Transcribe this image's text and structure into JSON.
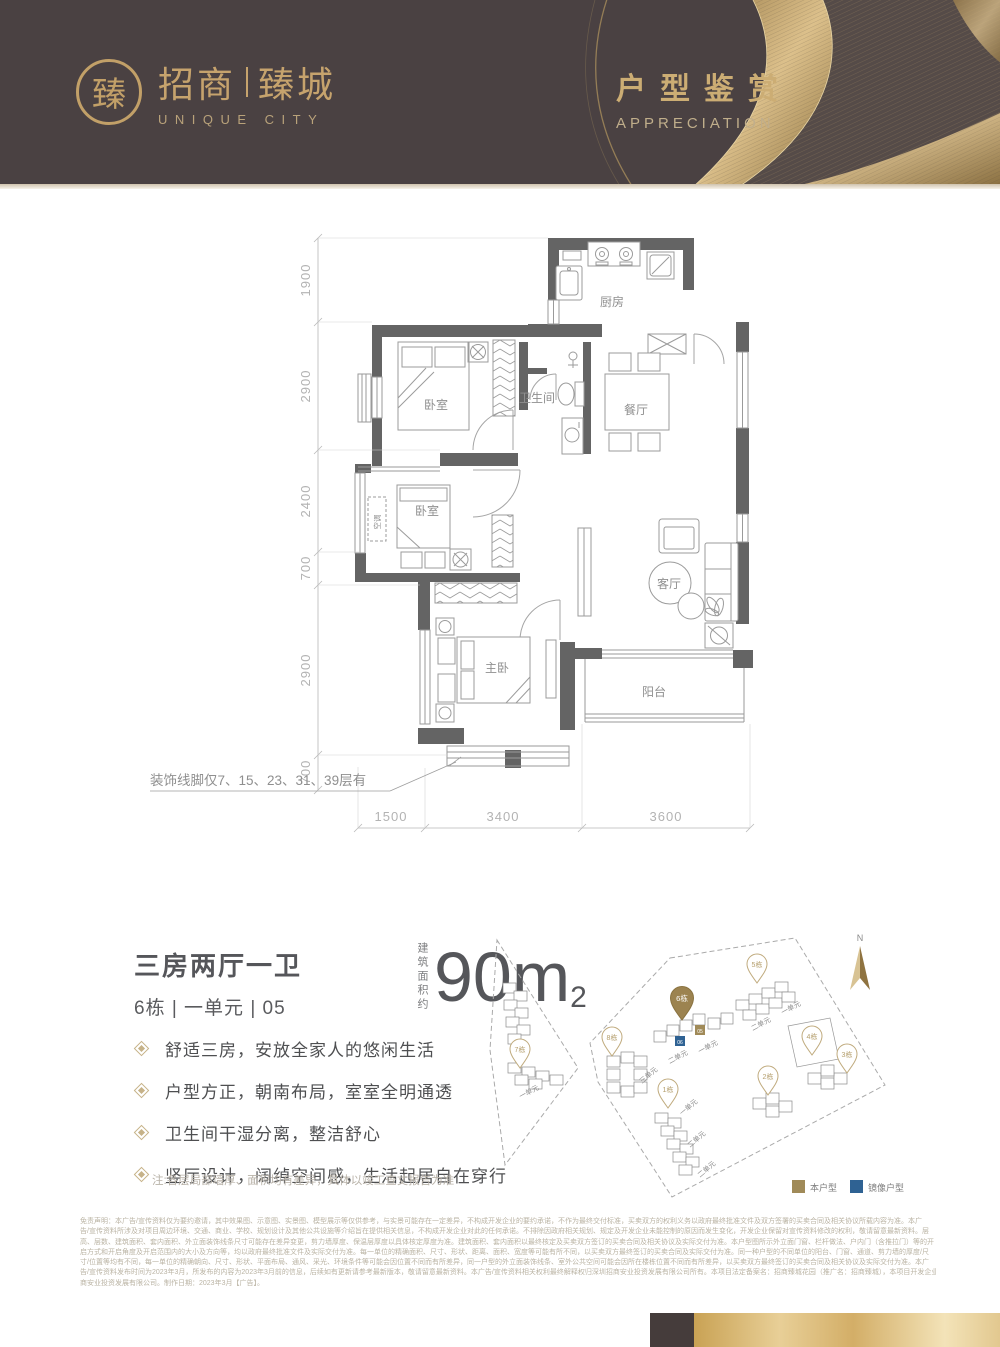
{
  "header": {
    "bg_color": "#4a4142",
    "gold_color": "#c6a36d",
    "logo_seal_char": "臻",
    "logo_cn_left": "招商",
    "logo_cn_right": "臻城",
    "logo_en": "UNIQUE CITY",
    "title_cn": "户型鉴赏",
    "title_en": "APPRECIATION"
  },
  "floorplan": {
    "rooms": {
      "kitchen": "厨房",
      "bath": "卫生间",
      "dining": "餐厅",
      "bedroom1": "卧室",
      "bedroom2": "卧室",
      "ac": "空调",
      "living": "客厅",
      "master": "主卧",
      "balcony": "阳台"
    },
    "dims_left": [
      "1900",
      "2900",
      "2400",
      "700",
      "2900",
      "700"
    ],
    "dims_bottom": [
      "1500",
      "3400",
      "3600"
    ],
    "molding_note": "装饰线脚仅7、15、23、31、39层有"
  },
  "unit_info": {
    "layout_title": "三房两厅一卫",
    "unit_line": "6栋 | 一单元 | 05",
    "area_label": "建筑面积约",
    "area_number": "90m",
    "area_sup": "2",
    "features": [
      "舒适三房，安放全家人的悠闲生活",
      "户型方正，朝南布局，室室全明通透",
      "卫生间干湿分离，整洁舒心",
      "竖厅设计，阔绰空间感，生活起居自在穿行"
    ],
    "note": "注:各层局部墙厚、面积均有差异，具体以竣工查丈报告为准"
  },
  "siteplan": {
    "north": "N",
    "buildings": {
      "b1": "1栋",
      "b2": "2栋",
      "b3": "3栋",
      "b4": "4栋",
      "b5": "5栋",
      "b6": "6栋",
      "b7": "7栋",
      "b8": "8栋"
    },
    "units": {
      "u7": "一单元",
      "u8": "三单元",
      "u6a": "二单元",
      "u6b": "一单元",
      "u5a": "二单元",
      "u5b": "一单元",
      "u1a": "一单元",
      "u1b": "二单元",
      "u1c": "二单元"
    },
    "this_unit_number": "05",
    "mirror_unit_number": "06",
    "legend_this": "本户型",
    "legend_mirror": "镜像户型",
    "colors": {
      "this": "#a08a58",
      "mirror": "#2f6293"
    }
  },
  "disclaimer": {
    "lines": [
      "免责声明：本广告/宣传资料仅为要约邀请，其中效果图、示意图、实景图、模型展示等仅供参考，与实景可能存在一定差异，不构成开发企业的要约承诺，不作为最终交付标准，买卖双方的权利义务以政府最终批准文件及双方签署的买卖合同及相关协议所载内容为准。本广",
      "告/宣传资料所涉及对项目周边环境、交通、商业、学校、规划设计及其他公共设施等介绍旨在提供相关信息，不构成开发企业对此的任何承诺。不排除因政府相关规划、规定及开发企业未能控制的原因而发生变化，开发企业保留对宣传资料修改的权利，敬请留意最新资料。层",
      "高、层数、建筑面积、套内面积、外立面装饰线条尺寸可能存在差异变更，剪力墙厚度、保温层厚度以具体核定厚度为准。建筑面积、套内面积以最终核定及买卖双方签订的买卖合同及相关协议及实际交付为准。本户型图所示外立面门窗、栏杆做法、户内门（含推拉门）等的开",
      "启方式和开启角度及开启范围内的大小及方向等，均以政府最终批准文件及实际交付为准。每一单位的精确面积、尺寸、形状、距离、面积、宽度等可能有所不同，以买卖双方最终签订的买卖合同及实际交付为准。同一种户型的不同单位的阳台、门窗、通道、剪力墙的厚度/尺",
      "寸/位置等均有不同，每一单位的精确朝向、尺寸、形状、平面布局、通风、采光、环境条件等可能会因位置不同而有所差异，同一户型的外立面装饰线条、室外公共空间可能会因所在楼栋位置不同而有所差异，以买卖双方最终签订的买卖合同及相关协议及实际交付为准。本广",
      "告/宣传资料发布时间为2023年3月，所发布的内容为2023年3月前的信息，后续如有更新请参考最新版本，敬请留意最新资料。本广告/宣传资料相关权利最终解释权归深圳招商安业投资发展有限公司所有。本项目法定备案名：招商臻城花园（推广名：招商臻城），本项目开发企业：深圳招",
      "商安业投资发展有限公司。制作日期：2023年3月【广告】。"
    ]
  }
}
